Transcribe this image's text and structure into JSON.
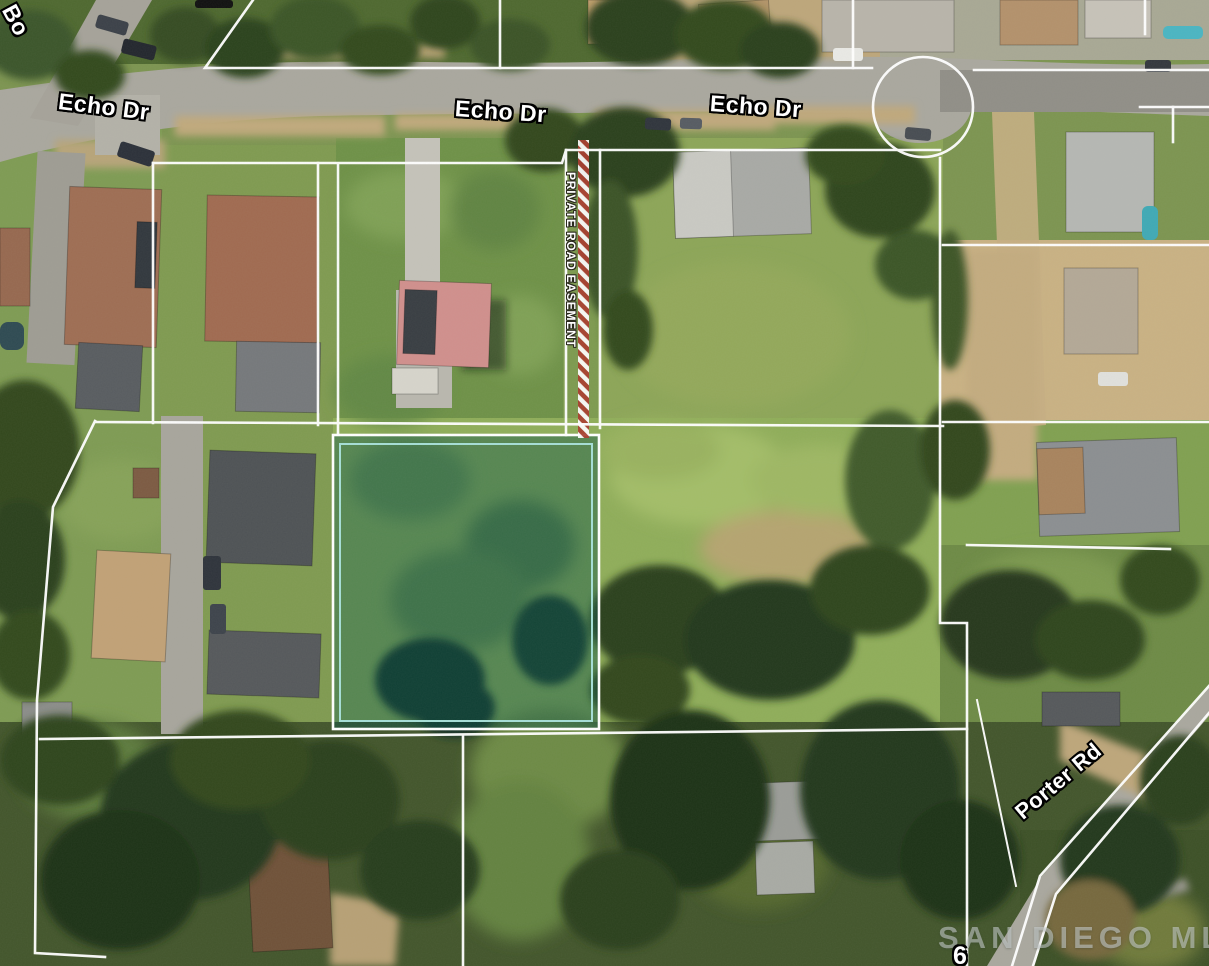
{
  "labels": {
    "street_partial_top_left": "Bo",
    "echo_dr": [
      "Echo Dr",
      "Echo Dr",
      "Echo Dr"
    ],
    "porter_rd": "Porter Rd",
    "private_road_easement": "PRIVATE ROAD EASEMENT",
    "watermark": "SAN DIEGO MLS",
    "cutoff_house_number": "6"
  },
  "colors": {
    "parcel_line": "#ffffff",
    "highlight_fill": "rgba(8,82,72,0.42)",
    "highlight_inner_border": "#a5ded6",
    "easement_stripe_red": "#a93c2d",
    "easement_stripe_white": "#ffffff",
    "label_text": "#ffffff",
    "label_outline": "#000000",
    "road_gray": "#a9a79e",
    "dirt_tan": "#c9b183",
    "grass_green": "#8fad59",
    "tree_dark": "#2b3f1b"
  }
}
